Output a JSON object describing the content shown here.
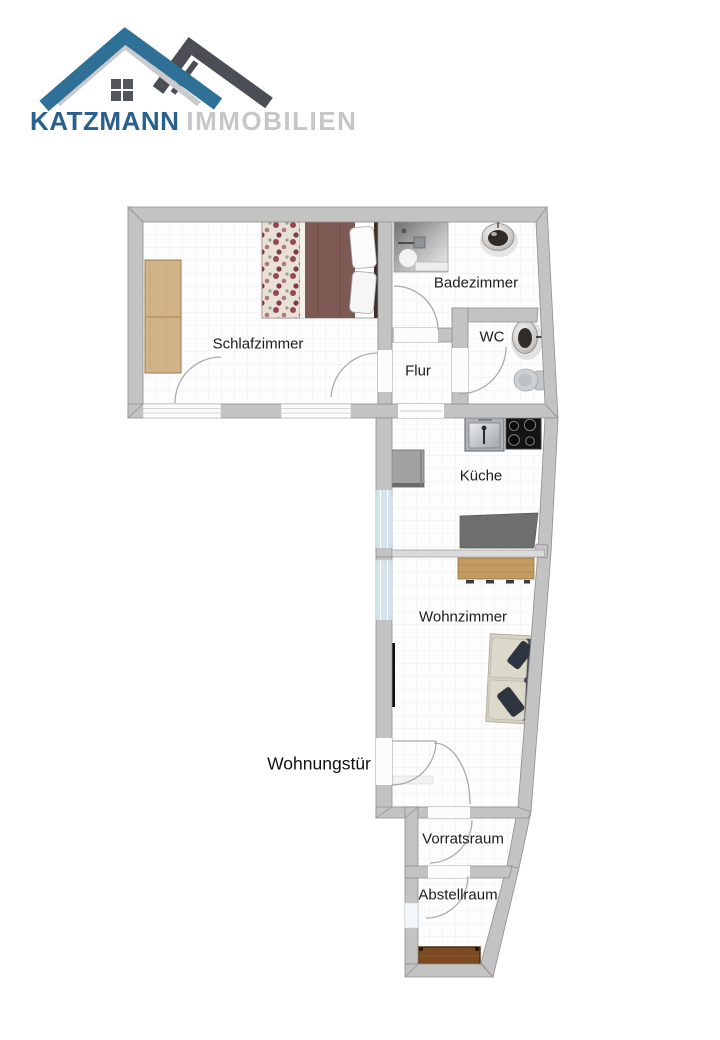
{
  "brand": {
    "primary": "KATZMANN",
    "secondary": "IMMOBILIEN"
  },
  "rooms": {
    "schlafzimmer": {
      "label": "Schlafzimmer"
    },
    "badezimmer": {
      "label": "Badezimmer"
    },
    "wc": {
      "label": "WC"
    },
    "flur": {
      "label": "Flur"
    },
    "kueche": {
      "label": "Küche"
    },
    "wohnzimmer": {
      "label": "Wohnzimmer"
    },
    "vorratsraum": {
      "label": "Vorratsraum"
    },
    "abstellraum": {
      "label": "Abstellraum"
    }
  },
  "annotations": {
    "entrance": {
      "label": "Wohnungstür"
    }
  },
  "palette": {
    "roof_blue": "#2f7096",
    "roof_dark": "#4b4f55",
    "roof_silver": "#c9cbcd",
    "brand_blue": "#2a608e",
    "brand_gray": "#c6c6c6",
    "wall_gray": "#c3c3c4",
    "wall_outline": "#8f8f8f",
    "window_blue": "#d3e4ec",
    "floor_white": "#fdfdfd",
    "tile_line": "#ededed",
    "wood_light": "#d1b388",
    "wood_mid": "#c39a61",
    "wood_dark": "#7c4a21",
    "blanket_brown": "#7d5a53",
    "counter_gray": "#6f6f70"
  }
}
